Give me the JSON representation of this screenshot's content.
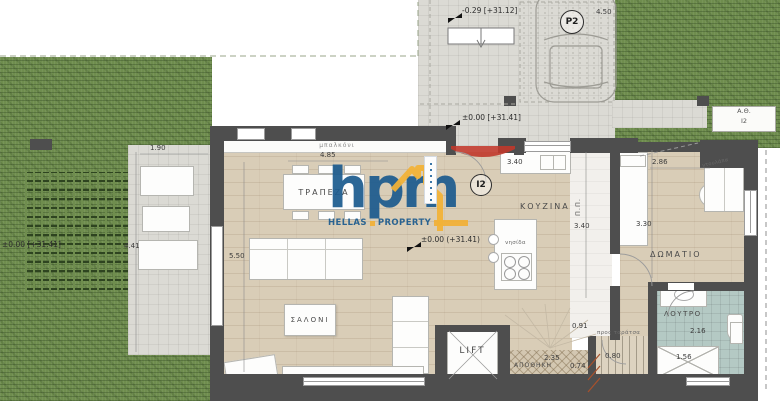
{
  "watermark": {
    "logo": "hpm",
    "word1": "HELLAS",
    "word2": "PROPERTY"
  },
  "labels": {
    "parking": "P2",
    "unit": "I2",
    "heatpump1": "Α.Θ.",
    "heatpump2": "I2",
    "lift": "LIFT"
  },
  "rooms": {
    "dining": "ΤΡΑΠΕΖΑ",
    "living": "ΣΑΛΟΝΙ",
    "kitchen": "ΚΟΥΖΙΝΑ",
    "bedroom": "ΔΩΜΑΤΙΟ",
    "bath": "ΛΟΥΤΡΟ",
    "storage": "ΑΠΟΘΗΚΗ",
    "balcony": "μπαλκόνι",
    "hall": "Π.Π.",
    "island": "νησίδα",
    "wardrobe": "ντουλάπα",
    "stairs_note": "προς ταράτσα"
  },
  "elevations": {
    "driveway": "-0.29 [+31.12]",
    "entrance": "±0.00 [+31.41]",
    "interior": "±0.00 (+31.41)",
    "garden": "±0.00 [+31.41]"
  },
  "dimensions": {
    "terrace_w": "1.90",
    "terrace_h": "4.41",
    "dining_w": "4.85",
    "living_w": "5.50",
    "counter": "3.40",
    "kitchen_h": "3.40",
    "bedroom_w": "2.86",
    "bedroom_h": "3.30",
    "parking": "4.50",
    "hall_w": "0.91",
    "storage_w": "2.35",
    "storage_h": "0.74",
    "stairs_w": "0.80",
    "shower_w": "1.56",
    "bath_h": "2.16"
  },
  "colors": {
    "grass": "#6f8d4e",
    "wall": "#4e4e4e",
    "floor": "#d9cdb7",
    "tile": "#b4c9c4",
    "accent_red": "#c0392b",
    "brand_blue": "#1d5c8f",
    "brand_yellow": "#f2b136"
  }
}
